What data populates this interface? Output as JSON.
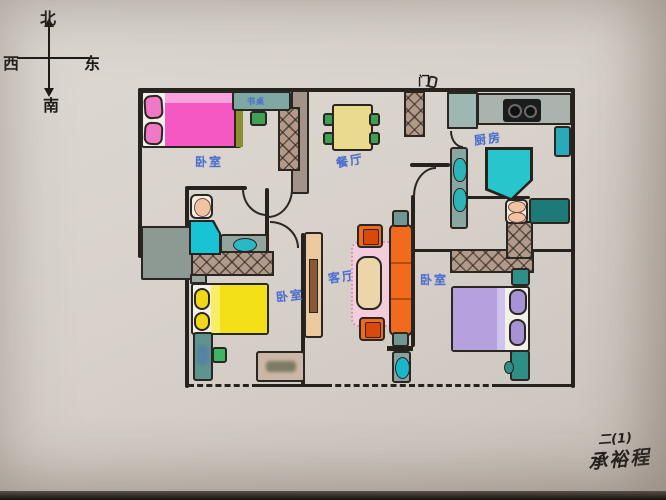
{
  "compass": {
    "north": "北",
    "south": "南",
    "east": "东",
    "west": "西"
  },
  "rooms": {
    "bedroom_top_left": "卧室",
    "bedroom_middle": "卧室",
    "bedroom_right": "卧室",
    "dining": "餐厅",
    "kitchen": "厨房",
    "living": "客厅"
  },
  "annotations": {
    "desk": "书桌",
    "entry_door": "门"
  },
  "signature": {
    "class_line": "二(1)",
    "name": "承裕程"
  },
  "colors": {
    "label_blue": "#4d6fd0",
    "bed_pink": "#f558c2",
    "bed_yellow": "#f4e016",
    "bed_purple": "#b6a1de",
    "sofa_orange": "#f26a1e",
    "dining_table_yellow": "#e9da8e",
    "fixture_teal": "#2db4b8",
    "chair_green": "#3fa054",
    "wall_black": "#26231f",
    "hatch_brown": "#b29a8b",
    "paper": "#d8d2cb"
  }
}
